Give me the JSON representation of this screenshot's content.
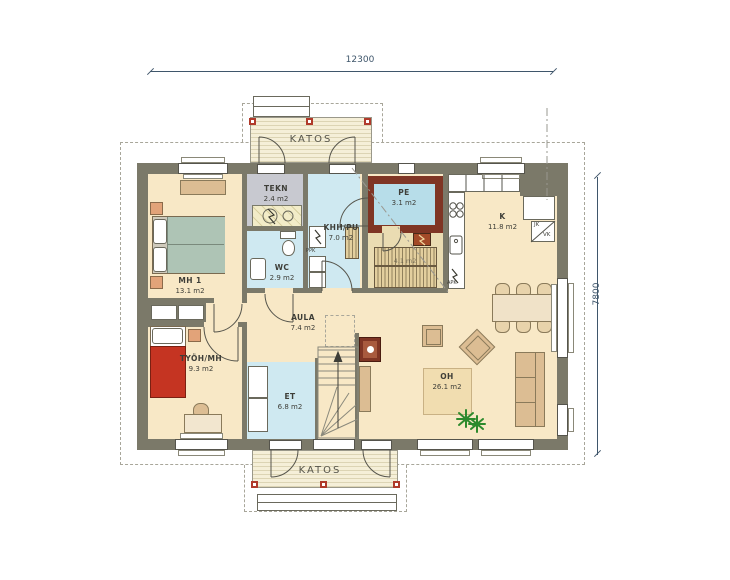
{
  "plan": {
    "dim_width": "12300",
    "dim_height": "7800",
    "katos_top": "KATOS",
    "katos_bottom": "KATOS",
    "rooms": {
      "mh1": {
        "name": "MH 1",
        "area": "13.1 m2"
      },
      "tekn": {
        "name": "TEKN",
        "area": "2.4 m2"
      },
      "wc": {
        "name": "WC",
        "area": "2.9 m2"
      },
      "khh": {
        "name": "KHH/PU",
        "area": "7.0 m2"
      },
      "pe": {
        "name": "PE",
        "area": "3.1 m2"
      },
      "sauna": {
        "name": "",
        "area": "4.1 m2"
      },
      "k": {
        "name": "K",
        "area": "11.8 m2"
      },
      "aula": {
        "name": "AULA",
        "area": "7.4 m2"
      },
      "tyoh": {
        "name": "TYÖH/MH",
        "area": "9.3 m2"
      },
      "et": {
        "name": "ET",
        "area": "6.8 m2"
      },
      "oh": {
        "name": "OH",
        "area": "26.1 m2"
      }
    },
    "appliances": {
      "fridge": "JK",
      "freezer": "VK",
      "washer": "PPK",
      "dishwasher": "APK"
    },
    "colors": {
      "wall": "#7b7969",
      "floor": "#f8e8c6",
      "wet_floor": "#cfe9f1",
      "pe_floor": "#b7dde9",
      "tekn_floor": "#c8c9d0",
      "sauna_wall_red": "#7f3524",
      "bed_red": "#c53422",
      "bed_green": "#aec4b5",
      "dimension_blue": "#3f566b"
    }
  }
}
